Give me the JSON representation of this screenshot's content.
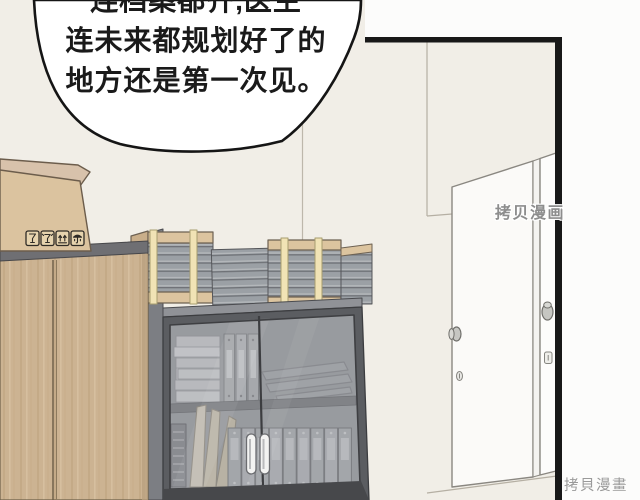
{
  "scene_label": "manhua-panel-office-storage-room",
  "speech_bubble": {
    "lines": {
      "line1": "连档案都齐,医生",
      "line2": "连未来都规划好了的",
      "line3": "地方还是第一次见。"
    }
  },
  "watermarks": {
    "middle": "拷贝漫画",
    "bottom": "拷貝漫畫"
  },
  "box_icons": [
    {
      "name": "fragile-icon",
      "glyph": "wine-glass"
    },
    {
      "name": "broken-glass-icon",
      "glyph": "cracked-wine-glass"
    },
    {
      "name": "this-side-up-icon",
      "glyph": "two-up-arrows"
    },
    {
      "name": "keep-dry-icon",
      "glyph": "umbrella"
    }
  ],
  "colors": {
    "page_background": "#fcfcfb",
    "wall": "#f1eee7",
    "panel_border": "#181818",
    "bubble_fill": "#ffffff",
    "bubble_stroke": "#151515",
    "speech_text": "#1a1a1a",
    "wood_cabinet": "#ccb392",
    "cardboard_box": "#dbc39f",
    "box_flap": "#d8c2ab",
    "dark_cabinet_frame": "#5b5d61",
    "cabinet_top": "#909297",
    "glass_tint": "#9a9da2",
    "binder_gray": "#aeb0b4",
    "binder_label": "#d8d9db",
    "folder_tan": "#ded4bf",
    "slab_gray": "#9ba0a5",
    "cap_tan": "#dcc49f",
    "strap_cream": "#f1e3b5",
    "door_white": "#fbfaf8",
    "watermark_gray": "#8d8d8d"
  }
}
